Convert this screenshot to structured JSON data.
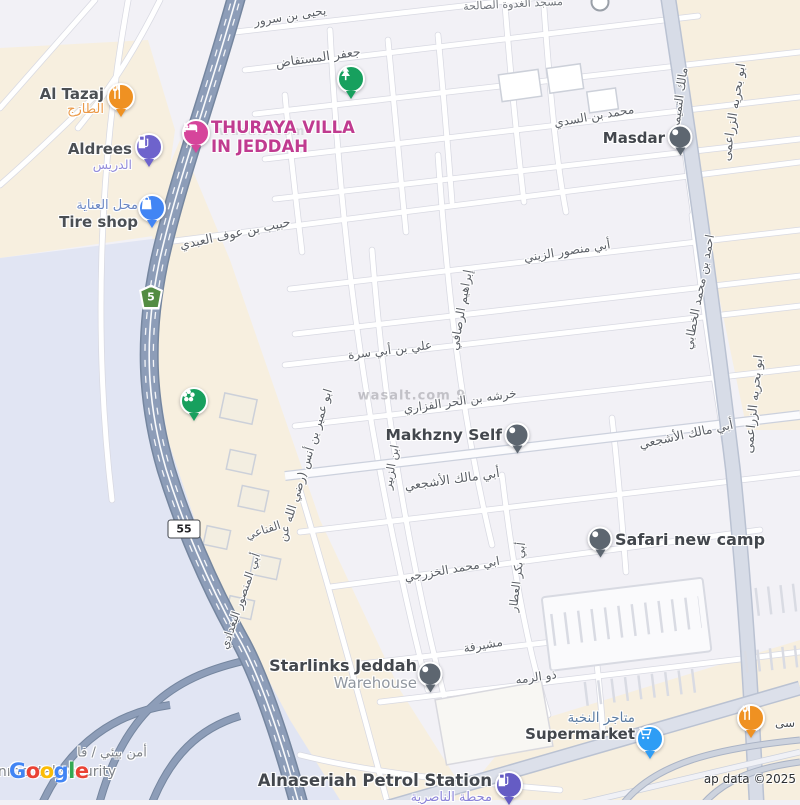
{
  "map": {
    "attribution": "ap data ©2025",
    "google_logo_letters": [
      "G",
      "o",
      "o",
      "g",
      "l",
      "e"
    ],
    "watermarks": [
      {
        "text": "wasalt.com 9",
        "x": 412,
        "y": 396,
        "size": 13,
        "opacity": 0.55
      },
      {
        "text": "wasalt.com",
        "x": 262,
        "y": 131,
        "size": 12,
        "opacity": 0.28
      }
    ],
    "shields": [
      {
        "route": "5",
        "style": "green",
        "x": 151,
        "y": 297
      },
      {
        "route": "55",
        "style": "white",
        "x": 184,
        "y": 529
      }
    ],
    "colors": {
      "city": "#f2f1f6",
      "beige_zone": "#f7efdf",
      "lavender_zone": "#e1e5f3",
      "highway": "#8d9db8",
      "highway_casing": "#75869f",
      "road_fill": "#ffffff",
      "road_casing": "#d8d9e2",
      "major_road_fill": "#d7dce7",
      "major_road_casing": "#bac2d2",
      "street_text": "#5c6067",
      "poi_text": "#43474d"
    },
    "street_labels": [
      {
        "text": "يحيى بن سرور",
        "x": 290,
        "y": 16,
        "rot": -9,
        "size": 12
      },
      {
        "text": "جعفر المستفاض",
        "x": 318,
        "y": 57,
        "rot": -8,
        "size": 12.5
      },
      {
        "text": "مسجد الغدوة الصالحة",
        "x": 513,
        "y": 4,
        "rot": -3,
        "size": 11,
        "color": "#70747b"
      },
      {
        "text": "محمد بن السدي",
        "x": 594,
        "y": 116,
        "rot": -10,
        "size": 12
      },
      {
        "text": "مالك التميمي",
        "x": 679,
        "y": 100,
        "rot": -82,
        "size": 12
      },
      {
        "text": "ابو بحريه الزراعمى",
        "x": 733,
        "y": 112,
        "rot": -81,
        "size": 12.5
      },
      {
        "text": "ابو بحريه الزراعمى",
        "x": 753,
        "y": 404,
        "rot": -84,
        "size": 12.5
      },
      {
        "text": "حبيب بن عوف العبدي",
        "x": 235,
        "y": 233,
        "rot": -12,
        "size": 12.5
      },
      {
        "text": "أبي منصور الزيني",
        "x": 567,
        "y": 251,
        "rot": -9,
        "size": 12
      },
      {
        "text": "إبراهيم الرصافي",
        "x": 461,
        "y": 310,
        "rot": -80,
        "size": 12
      },
      {
        "text": "علي بن أبي سرة",
        "x": 390,
        "y": 350,
        "rot": -7,
        "size": 12
      },
      {
        "text": "خرشه بن الحر الفزاري",
        "x": 460,
        "y": 401,
        "rot": -8,
        "size": 12
      },
      {
        "text": "أبي مالك الأشجعي",
        "x": 452,
        "y": 479,
        "rot": -8,
        "size": 12.5
      },
      {
        "text": "أبي مالك الأشجعي",
        "x": 686,
        "y": 434,
        "rot": -12,
        "size": 12.5
      },
      {
        "text": "احمد بن محمد الخطابي",
        "x": 699,
        "y": 292,
        "rot": -79,
        "size": 12
      },
      {
        "text": "ابن الزبير",
        "x": 391,
        "y": 467,
        "rot": -80,
        "size": 11.5
      },
      {
        "text": "ابو عمير بن أنس (رضي الله عن",
        "x": 305,
        "y": 465,
        "rot": -73,
        "size": 12
      },
      {
        "text": "الفناعي",
        "x": 263,
        "y": 530,
        "rot": -18,
        "size": 11.5
      },
      {
        "text": "أبي المنصور البغدادي",
        "x": 240,
        "y": 601,
        "rot": -71,
        "size": 11.5
      },
      {
        "text": "أبي بكر العطار",
        "x": 517,
        "y": 577,
        "rot": -83,
        "size": 11.5
      },
      {
        "text": "ابي محمد الخزرجي",
        "x": 452,
        "y": 569,
        "rot": -10,
        "size": 12
      },
      {
        "text": "مشيرفة",
        "x": 483,
        "y": 645,
        "rot": -10,
        "size": 12
      },
      {
        "text": "ذو الرمه",
        "x": 536,
        "y": 677,
        "rot": -8,
        "size": 12
      },
      {
        "text": "أمن بيئي / فا",
        "x": 112,
        "y": 753,
        "rot": 0,
        "size": 13,
        "color": "#7f8389"
      },
      {
        "text": "nmental security",
        "x": 57,
        "y": 772,
        "rot": 0,
        "size": 14,
        "color": "#7f8389"
      }
    ],
    "pois": [
      {
        "id": "al-tazaj",
        "x": 121,
        "y": 100,
        "marker": "pin",
        "color": "#ef9122",
        "icon": "restaurant-icon",
        "label": {
          "side": "left",
          "gap": 17,
          "dy": -14,
          "lines": [
            {
              "t": "Al Tazaj",
              "s": 15,
              "c": "#4b4f54",
              "b": 1
            },
            {
              "t": "الطازج",
              "s": 13,
              "c": "#eb9a49"
            }
          ]
        }
      },
      {
        "id": "thuraya-villa",
        "x": 196,
        "y": 136,
        "marker": "pin",
        "color": "#d6459b",
        "icon": "hotel-icon",
        "label": {
          "side": "right",
          "gap": 15,
          "dy": -17,
          "lines": [
            {
              "t": "THURAYA VILLA",
              "s": 16.5,
              "c": "#c03b90",
              "b": 1
            },
            {
              "t": "IN JEDDAH",
              "s": 16.5,
              "c": "#c03b90",
              "b": 1
            }
          ]
        }
      },
      {
        "id": "aldrees",
        "x": 149,
        "y": 150,
        "marker": "pin",
        "color": "#6e63cc",
        "icon": "gas-pump-icon",
        "label": {
          "side": "left",
          "gap": 17,
          "dy": -9,
          "lines": [
            {
              "t": "Aldrees",
              "s": 15,
              "c": "#4b4f54",
              "b": 1
            },
            {
              "t": "الدريس",
              "s": 12.5,
              "c": "#938cdb"
            }
          ]
        }
      },
      {
        "id": "tire-shop",
        "x": 152,
        "y": 211,
        "marker": "pin",
        "color": "#4285f4",
        "icon": "shopping-bag-icon",
        "label": {
          "side": "left",
          "gap": 14,
          "dy": -12,
          "lines": [
            {
              "t": "محل العناية",
              "s": 13,
              "c": "#6b87c4"
            },
            {
              "t": "Tire shop",
              "s": 15,
              "c": "#4b4f54",
              "b": 1
            }
          ]
        }
      },
      {
        "id": "park-tree",
        "x": 351,
        "y": 82,
        "marker": "pin",
        "color": "#17a05e",
        "icon": "tree-icon"
      },
      {
        "id": "masdar",
        "x": 680,
        "y": 140,
        "marker": "dot",
        "color": "#5d6670",
        "icon": "dot-icon",
        "label": {
          "side": "left",
          "gap": 15,
          "dy": -10,
          "lines": [
            {
              "t": "Masdar",
              "s": 15,
              "c": "#43474d",
              "b": 1
            }
          ]
        }
      },
      {
        "id": "garden-flower",
        "x": 194,
        "y": 404,
        "marker": "pin",
        "color": "#17a05e",
        "icon": "flower-icon"
      },
      {
        "id": "makhzny-self",
        "x": 517,
        "y": 438,
        "marker": "dot",
        "color": "#5d6670",
        "icon": "dot-icon",
        "label": {
          "side": "left",
          "gap": 15,
          "dy": -11,
          "lines": [
            {
              "t": "Makhzny Self",
              "s": 15.5,
              "c": "#43474d",
              "b": 1
            }
          ]
        }
      },
      {
        "id": "safari-new-camp",
        "x": 600,
        "y": 542,
        "marker": "dot",
        "color": "#5d6670",
        "icon": "dot-icon",
        "label": {
          "side": "right",
          "gap": 15,
          "dy": -11,
          "lines": [
            {
              "t": "Safari new camp",
              "s": 16,
              "c": "#43474d",
              "b": 1
            }
          ]
        }
      },
      {
        "id": "starlinks-jeddah",
        "x": 430,
        "y": 677,
        "marker": "dot",
        "color": "#5d6670",
        "icon": "dot-icon",
        "label": {
          "side": "left",
          "gap": 13,
          "dy": -20,
          "lines": [
            {
              "t": "Starlinks Jeddah",
              "s": 16,
              "c": "#43474d",
              "b": 1
            },
            {
              "t": "Warehouse",
              "s": 15,
              "c": "#9197a0"
            }
          ]
        }
      },
      {
        "id": "supermarket-elite",
        "x": 650,
        "y": 742,
        "marker": "pin",
        "color": "#2e9df5",
        "icon": "cart-icon",
        "label": {
          "side": "left",
          "gap": 15,
          "dy": -31,
          "lines": [
            {
              "t": "متاجر النخبة",
              "s": 13.5,
              "c": "#5b7ca3"
            },
            {
              "t": "Supermarket",
              "s": 15,
              "c": "#43474d",
              "b": 1
            }
          ]
        }
      },
      {
        "id": "alnaseriah-petrol",
        "x": 509,
        "y": 788,
        "marker": "pin",
        "color": "#655cc4",
        "icon": "gas-pump-icon",
        "label": {
          "side": "left",
          "gap": 17,
          "dy": -16,
          "lines": [
            {
              "t": "Alnaseriah Petrol Station",
              "s": 16.5,
              "c": "#43474d",
              "b": 1
            },
            {
              "t": "محطة الناصرية",
              "s": 13,
              "c": "#8b84d9"
            }
          ]
        }
      },
      {
        "id": "restaurant-southeast",
        "x": 751,
        "y": 721,
        "marker": "pin",
        "color": "#ef9122",
        "icon": "restaurant-icon",
        "label": {
          "side": "right",
          "gap": 24,
          "dy": -4,
          "lines": [
            {
              "t": "سى",
              "s": 12,
              "c": "#4b4f54"
            }
          ]
        }
      },
      {
        "id": "mosque-marker",
        "x": 600,
        "y": 2,
        "marker": "ring"
      }
    ]
  }
}
